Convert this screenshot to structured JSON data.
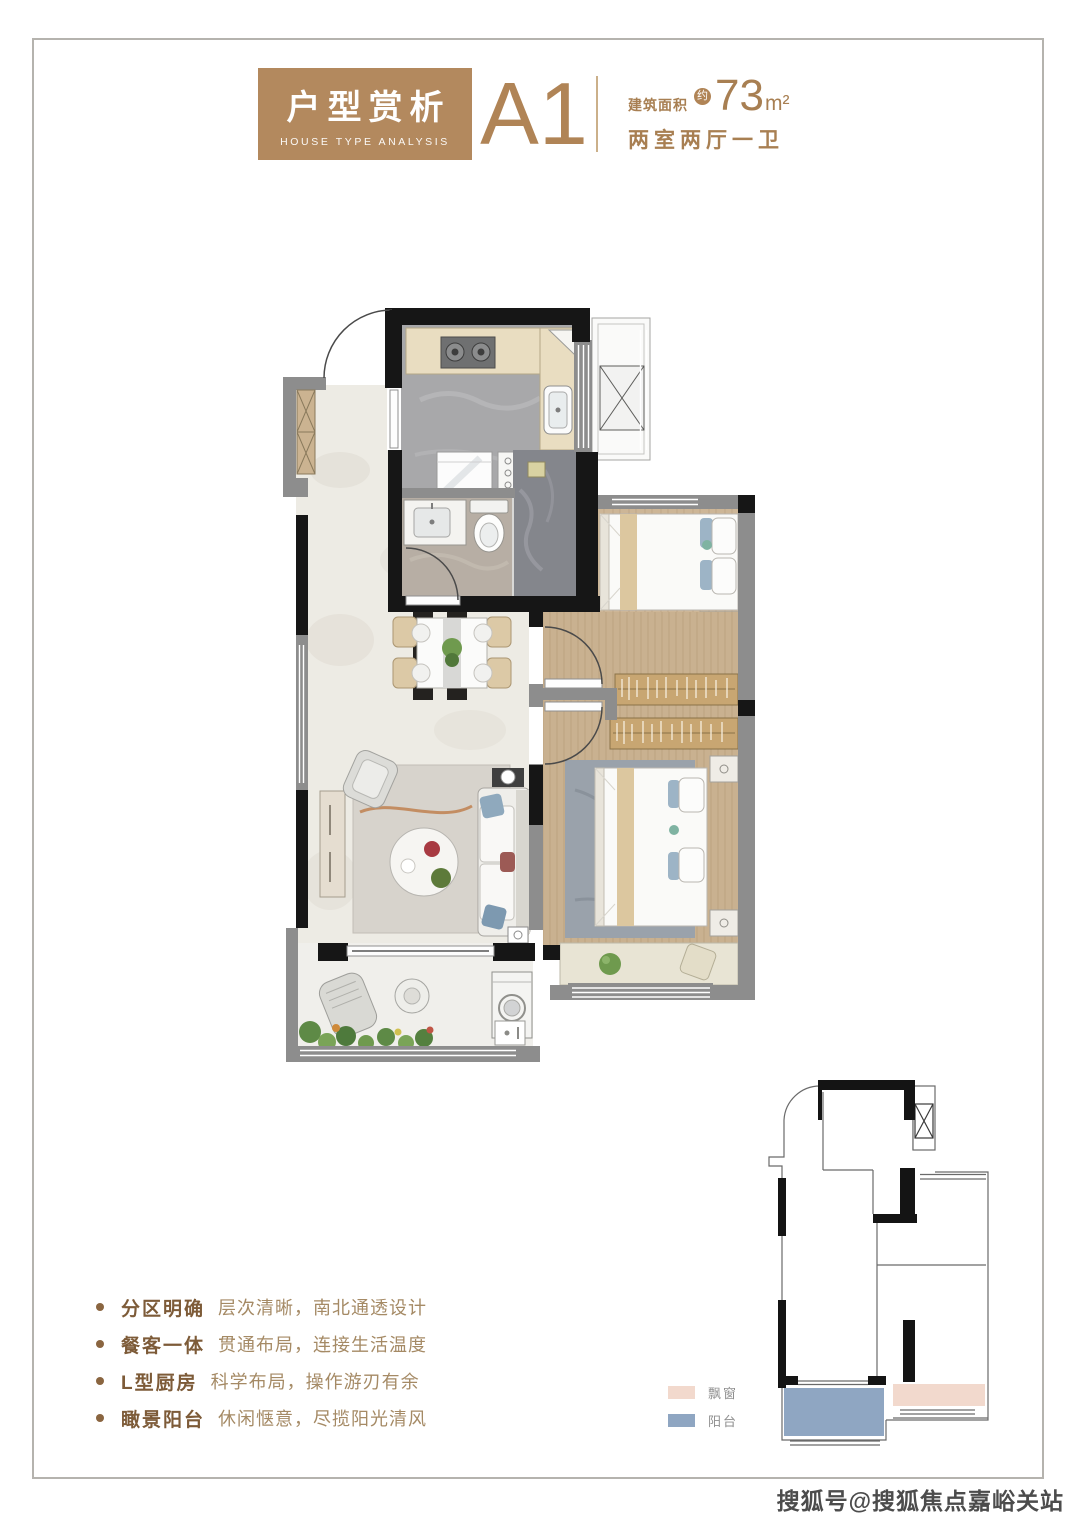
{
  "header": {
    "title_cn": "户型赏析",
    "title_en": "HOUSE TYPE ANALYSIS",
    "unit_name": "A1",
    "area_label": "建筑面积",
    "area_approx": "约",
    "area_value": "73",
    "area_unit": "m²",
    "layout_text": "两室两厅一卫",
    "brand_brown": "#b3895e",
    "text_brown": "#a87f52"
  },
  "features": {
    "items": [
      {
        "label": "分区明确",
        "desc": "层次清晰，南北通透设计"
      },
      {
        "label": "餐客一体",
        "desc": "贯通布局，连接生活温度"
      },
      {
        "label": "L型厨房",
        "desc": "科学布局，操作游刃有余"
      },
      {
        "label": "瞰景阳台",
        "desc": "休闲惬意，尽揽阳光清风"
      }
    ],
    "bullet_color": "#8a6540"
  },
  "legend": {
    "items": [
      {
        "label": "飘窗",
        "color": "#f2d9cd"
      },
      {
        "label": "阳台",
        "color": "#8fa6c2"
      }
    ]
  },
  "watermark": {
    "text": "搜狐号@搜狐焦点嘉峪关站"
  },
  "floor_plan_colors": {
    "wall_black": "#161616",
    "wall_gray": "#8d8d8d",
    "marble_floor": "#edebe4",
    "kitchen_floor": "#a8a8aa",
    "shower_floor": "#84868c",
    "bath_floor": "#b7aea4",
    "wood_floor": "#c9b190",
    "counter": "#e9ddc1",
    "master_rug": "#9aa2ab",
    "balcony_floor": "#f0efeb",
    "bay_mat": "#e8e4d4"
  }
}
